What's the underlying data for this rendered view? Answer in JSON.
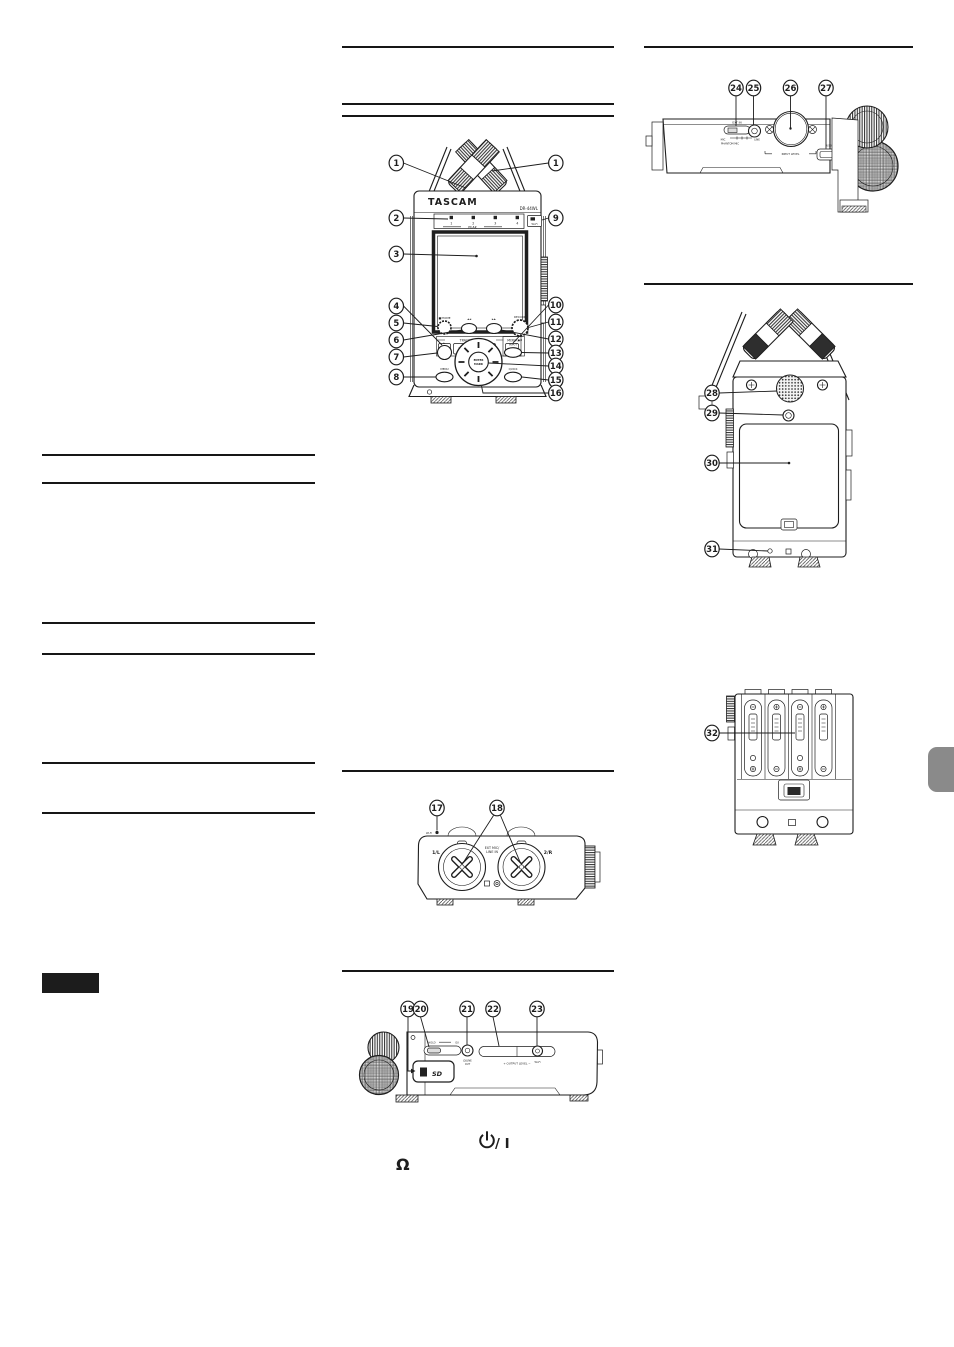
{
  "views": {
    "front": {
      "callouts": [
        "1",
        "1",
        "2",
        "3",
        "4",
        "5",
        "6",
        "7",
        "8",
        "9",
        "10",
        "11",
        "12",
        "13",
        "14",
        "15",
        "16"
      ],
      "labels": {
        "brand": "TASCAM",
        "model": "DR-44WL",
        "peak": "PEAK",
        "peak_leds": [
          "1",
          "2",
          "3",
          "4"
        ],
        "wifi": "Wi-Fi",
        "track_input": "TRACK/INPUT",
        "mixer": "MIXER",
        "tracks": [
          "1",
          "2",
          "3",
          "4"
        ],
        "stop_home": "■/HOME",
        "rew": "◄◄",
        "ff": "►►",
        "record": "RECORD",
        "rec_icons": "●/II",
        "play": "►",
        "input": "INPUT",
        "enter": "ENTER",
        "mark": "MARK",
        "menu": "MENU",
        "quick": "QUICK"
      }
    },
    "bottom": {
      "callouts": [
        "17",
        "18"
      ],
      "labels": {
        "wifi": "Wi-Fi",
        "jack_left": "1/L",
        "jack_right": "2/R",
        "ext_mic_1": "EXT MIC/",
        "ext_mic_2": "LINE IN"
      }
    },
    "left_side": {
      "callouts": [
        "19",
        "20",
        "21",
        "22",
        "23"
      ],
      "labels": {
        "hold": "HOLD",
        "power": "O/I",
        "sd": "SD",
        "phones_line_1": "Ω/LINE",
        "phones_line_2": "OUT",
        "output_level": "+ OUTPUT LEVEL −",
        "wifi": "Wi-Fi"
      }
    },
    "right_side": {
      "callouts": [
        "24",
        "25",
        "26",
        "27"
      ],
      "labels": {
        "ext_in": "EXT IN",
        "mic": "MIC",
        "line": "LINE",
        "phantom": "PHANTOM MIC",
        "input_level": "INPUT LEVEL",
        "usb": "USB"
      }
    },
    "rear": {
      "callouts": [
        "28",
        "29",
        "30",
        "31"
      ]
    },
    "battery": {
      "callouts": [
        "32"
      ]
    }
  },
  "symbols": {
    "power_icon": "power-standby",
    "power_text": "/ I",
    "headphone": "Ω"
  },
  "colors": {
    "line_art": "#1d1d1d",
    "rule": "#161616",
    "badge": "#1c1c1c",
    "page_tab": "#8a8a8a"
  }
}
